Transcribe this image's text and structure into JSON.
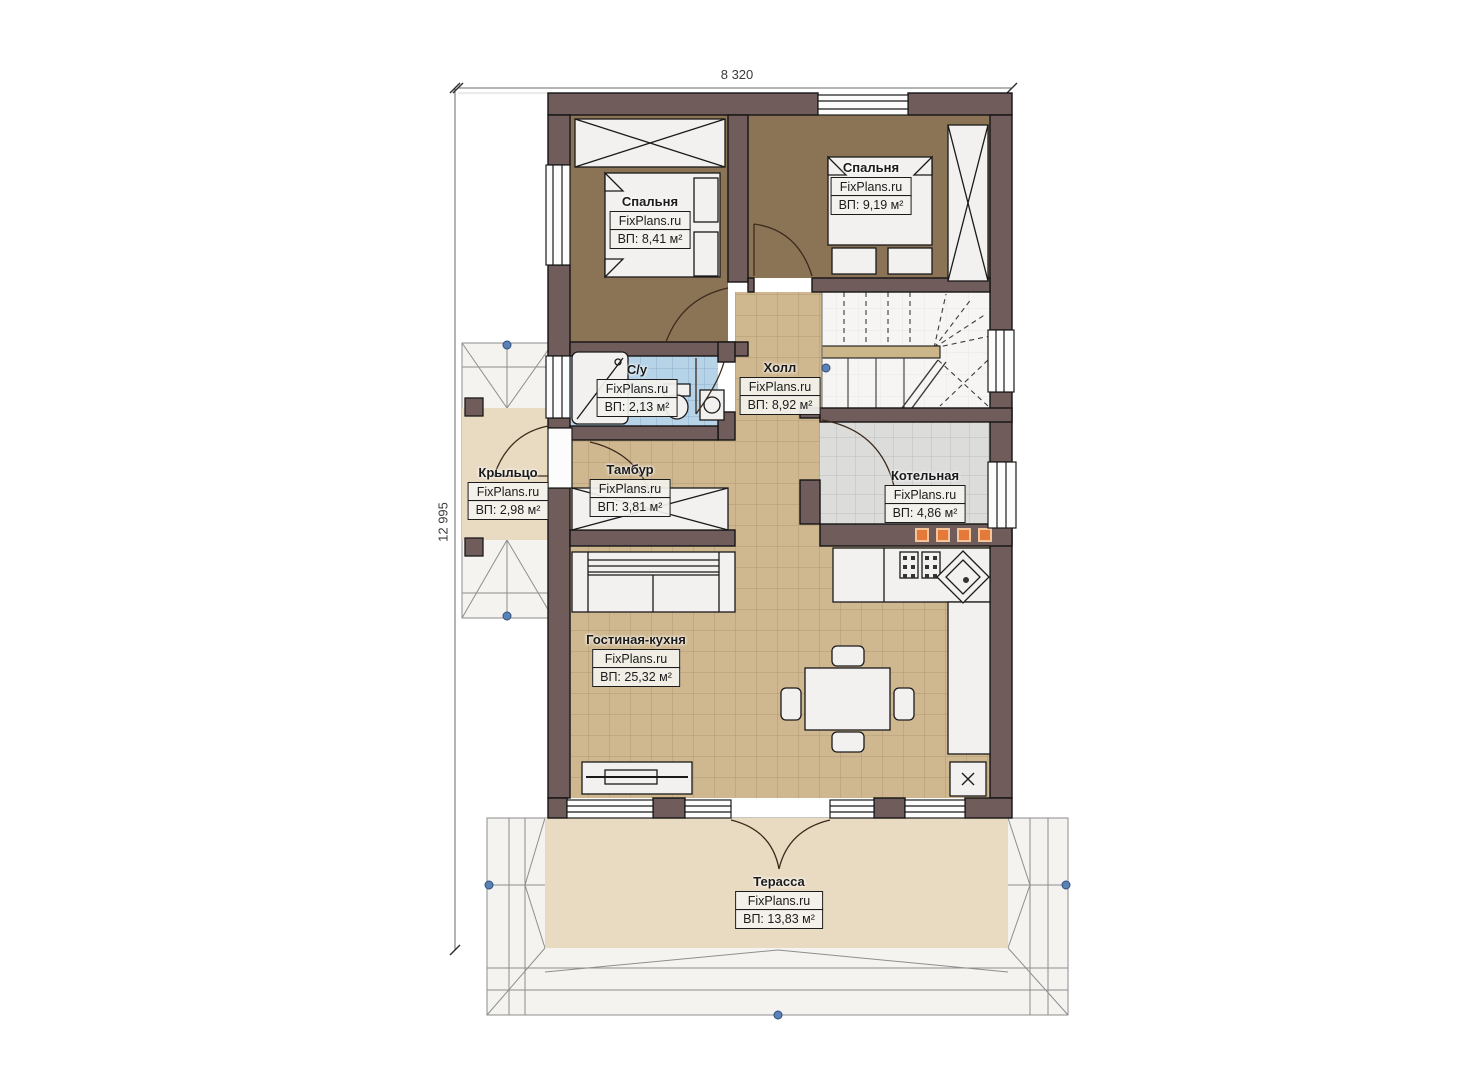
{
  "watermark": "FixPlans.ru",
  "dims": {
    "width": "8 320",
    "height": "12 995"
  },
  "rooms": [
    {
      "id": "bedroom-1",
      "name": "Спальня",
      "area": "ВП: 8,41 м²"
    },
    {
      "id": "bedroom-2",
      "name": "Спальня",
      "area": "ВП: 9,19 м²"
    },
    {
      "id": "bathroom",
      "name": "С/у",
      "area": "ВП: 2,13 м²"
    },
    {
      "id": "hall",
      "name": "Холл",
      "area": "ВП: 8,92 м²"
    },
    {
      "id": "vestibule",
      "name": "Тамбур",
      "area": "ВП: 3,81 м²"
    },
    {
      "id": "porch",
      "name": "Крыльцо",
      "area": "ВП: 2,98 м²"
    },
    {
      "id": "boiler",
      "name": "Котельная",
      "area": "ВП: 4,86 м²"
    },
    {
      "id": "living",
      "name": "Гостиная-кухня",
      "area": "ВП: 25,32 м²"
    },
    {
      "id": "terrace",
      "name": "Терасса",
      "area": "ВП: 13,83 м²"
    }
  ],
  "colors": {
    "wall": "#6f5c5b",
    "bedroom_floor": "#8b7456",
    "tile_beige": "#cfb890",
    "tile_blue": "#b7d3e7",
    "tile_gray": "#dcdcda",
    "terrace_floor": "#e9dac2",
    "roof": "#f4f3f0",
    "accent_orange": "#e5793a",
    "marker_blue": "#5b82b5"
  }
}
